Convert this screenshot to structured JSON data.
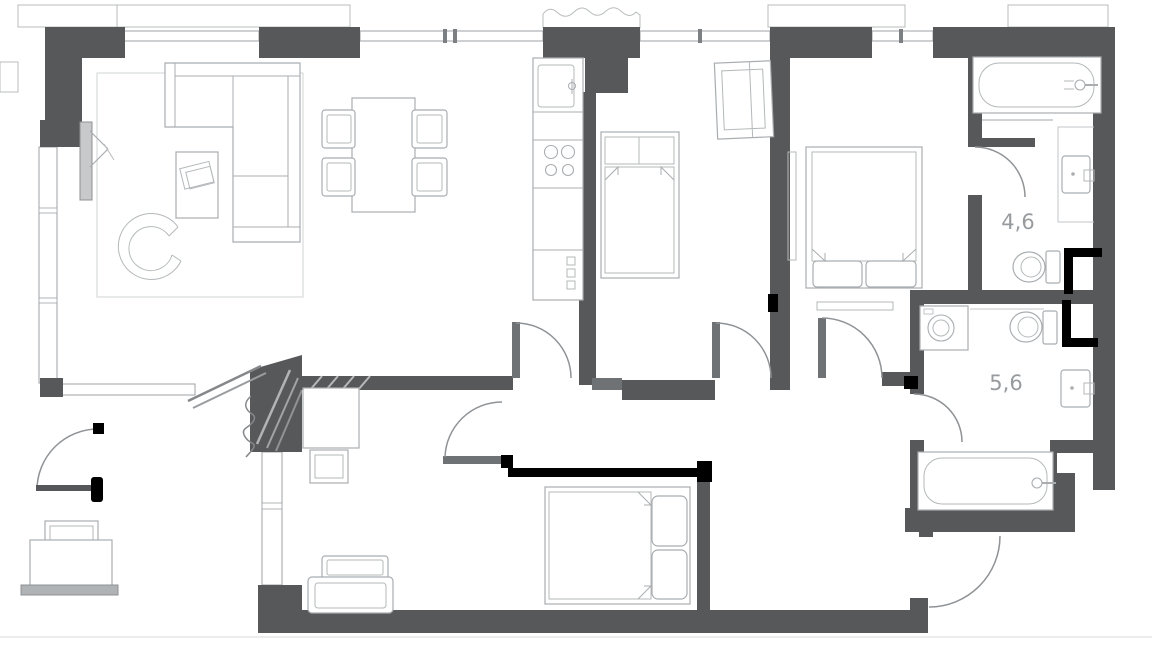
{
  "plan": {
    "type": "apartment-floor-plan",
    "rooms": {
      "bathroom_top": {
        "label": "4,6"
      },
      "bathroom_bottom": {
        "label": "5,6"
      }
    },
    "fixtures": [
      "corner-sofa-icon",
      "coffee-table-icon",
      "lounge-chair-icon",
      "rug-icon",
      "tv-panel-icon",
      "dining-table-icon",
      "dining-chair-icon",
      "kitchen-sink-icon",
      "cooktop-icon",
      "kitchen-counter-icon",
      "single-bed-icon",
      "wardrobe-icon",
      "double-bed-icon",
      "bathtub-icon",
      "washbasin-icon",
      "toilet-icon",
      "washing-machine-icon",
      "desk-icon",
      "desk-chair-icon",
      "armchair-icon",
      "bench-icon",
      "door-swing-icon",
      "entry-door-icon",
      "window-icon",
      "balcony-railing-icon"
    ],
    "annotations": {
      "style": "hand-drawn-black-marker",
      "color": "#000000",
      "items": [
        "wall-line-proposal",
        "toilet-bracket-upper",
        "toilet-bracket-lower",
        "door-swing-mark",
        "hinge-ticks"
      ]
    },
    "palette": {
      "wall": "#57585a",
      "furniture_line": "#a9adb0",
      "door_arc": "#8f9396",
      "label": "#979b9e",
      "annotation": "#000000",
      "background": "#ffffff"
    }
  }
}
